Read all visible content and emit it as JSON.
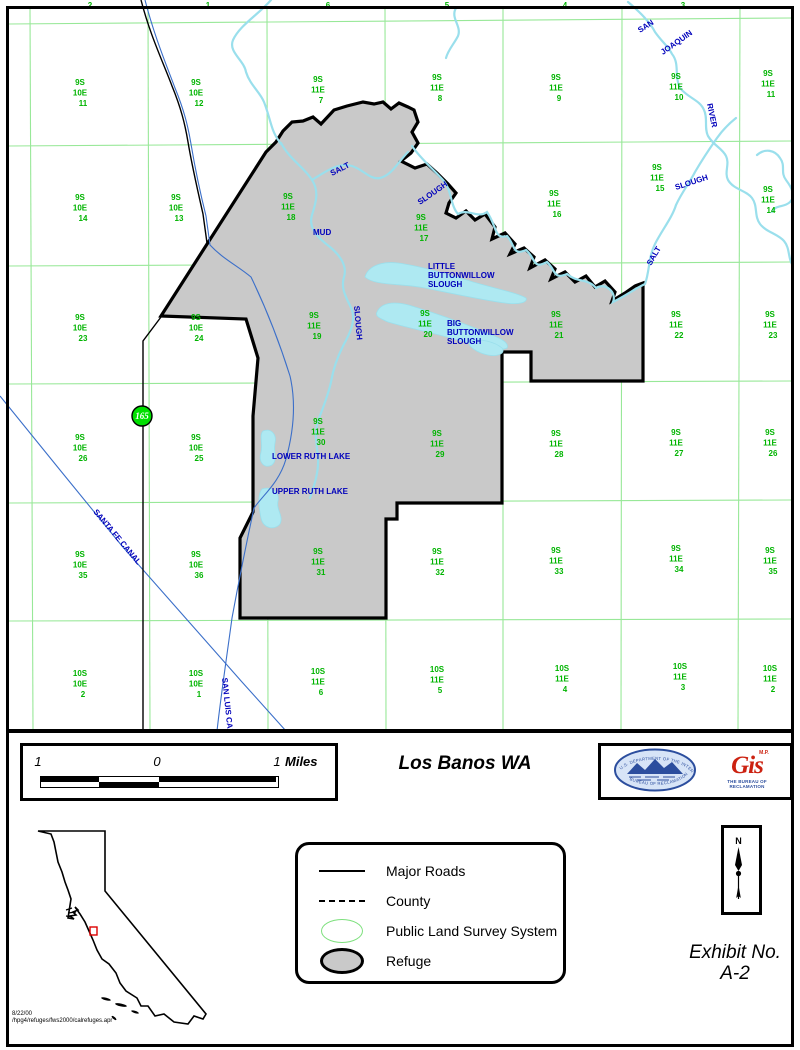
{
  "colors": {
    "plss_green": "#00b400",
    "grid_green": "#98e898",
    "water_blue": "#0000bb",
    "water_cyan": "#9adfec",
    "water_fill": "#aee9f2",
    "canal_blue": "#3b6fc9",
    "refuge_gray": "#c9c9c9",
    "shield_green": "#00e000",
    "logo_red": "#cc2211",
    "locator_red": "#dd0000",
    "seal_blue": "#2c4e9e"
  },
  "map": {
    "highway_shield": {
      "route": "165"
    },
    "plss_partial_top": [
      {
        "x": 90,
        "sec": "2"
      },
      {
        "x": 208,
        "sec": "1"
      },
      {
        "x": 328,
        "sec": "6"
      },
      {
        "x": 447,
        "sec": "5"
      },
      {
        "x": 565,
        "sec": "4"
      },
      {
        "x": 683,
        "sec": "3"
      }
    ],
    "plss_sections": [
      {
        "x": 80,
        "y": 85,
        "town": "9S",
        "range": "10E",
        "sec": "11"
      },
      {
        "x": 196,
        "y": 85,
        "town": "9S",
        "range": "10E",
        "sec": "12"
      },
      {
        "x": 318,
        "y": 82,
        "town": "9S",
        "range": "11E",
        "sec": "7"
      },
      {
        "x": 437,
        "y": 80,
        "town": "9S",
        "range": "11E",
        "sec": "8"
      },
      {
        "x": 556,
        "y": 80,
        "town": "9S",
        "range": "11E",
        "sec": "9"
      },
      {
        "x": 676,
        "y": 79,
        "town": "9S",
        "range": "11E",
        "sec": "10"
      },
      {
        "x": 768,
        "y": 76,
        "town": "9S",
        "range": "11E",
        "sec": "11"
      },
      {
        "x": 80,
        "y": 200,
        "town": "9S",
        "range": "10E",
        "sec": "14"
      },
      {
        "x": 176,
        "y": 200,
        "town": "9S",
        "range": "10E",
        "sec": "13"
      },
      {
        "x": 288,
        "y": 199,
        "town": "9S",
        "range": "11E",
        "sec": "18"
      },
      {
        "x": 421,
        "y": 220,
        "town": "9S",
        "range": "11E",
        "sec": "17"
      },
      {
        "x": 554,
        "y": 196,
        "town": "9S",
        "range": "11E",
        "sec": "16"
      },
      {
        "x": 657,
        "y": 170,
        "town": "9S",
        "range": "11E",
        "sec": "15"
      },
      {
        "x": 768,
        "y": 192,
        "town": "9S",
        "range": "11E",
        "sec": "14"
      },
      {
        "x": 80,
        "y": 320,
        "town": "9S",
        "range": "10E",
        "sec": "23"
      },
      {
        "x": 196,
        "y": 320,
        "town": "9S",
        "range": "10E",
        "sec": "24"
      },
      {
        "x": 314,
        "y": 318,
        "town": "9S",
        "range": "11E",
        "sec": "19"
      },
      {
        "x": 425,
        "y": 316,
        "town": "9S",
        "range": "11E",
        "sec": "20"
      },
      {
        "x": 556,
        "y": 317,
        "town": "9S",
        "range": "11E",
        "sec": "21"
      },
      {
        "x": 676,
        "y": 317,
        "town": "9S",
        "range": "11E",
        "sec": "22"
      },
      {
        "x": 770,
        "y": 317,
        "town": "9S",
        "range": "11E",
        "sec": "23"
      },
      {
        "x": 80,
        "y": 440,
        "town": "9S",
        "range": "10E",
        "sec": "26"
      },
      {
        "x": 196,
        "y": 440,
        "town": "9S",
        "range": "10E",
        "sec": "25"
      },
      {
        "x": 318,
        "y": 424,
        "town": "9S",
        "range": "11E",
        "sec": "30"
      },
      {
        "x": 437,
        "y": 436,
        "town": "9S",
        "range": "11E",
        "sec": "29"
      },
      {
        "x": 556,
        "y": 436,
        "town": "9S",
        "range": "11E",
        "sec": "28"
      },
      {
        "x": 676,
        "y": 435,
        "town": "9S",
        "range": "11E",
        "sec": "27"
      },
      {
        "x": 770,
        "y": 435,
        "town": "9S",
        "range": "11E",
        "sec": "26"
      },
      {
        "x": 80,
        "y": 557,
        "town": "9S",
        "range": "10E",
        "sec": "35"
      },
      {
        "x": 196,
        "y": 557,
        "town": "9S",
        "range": "10E",
        "sec": "36"
      },
      {
        "x": 318,
        "y": 554,
        "town": "9S",
        "range": "11E",
        "sec": "31"
      },
      {
        "x": 437,
        "y": 554,
        "town": "9S",
        "range": "11E",
        "sec": "32"
      },
      {
        "x": 556,
        "y": 553,
        "town": "9S",
        "range": "11E",
        "sec": "33"
      },
      {
        "x": 676,
        "y": 551,
        "town": "9S",
        "range": "11E",
        "sec": "34"
      },
      {
        "x": 770,
        "y": 553,
        "town": "9S",
        "range": "11E",
        "sec": "35"
      },
      {
        "x": 80,
        "y": 676,
        "town": "10S",
        "range": "10E",
        "sec": "2"
      },
      {
        "x": 196,
        "y": 676,
        "town": "10S",
        "range": "10E",
        "sec": "1"
      },
      {
        "x": 318,
        "y": 674,
        "town": "10S",
        "range": "11E",
        "sec": "6"
      },
      {
        "x": 437,
        "y": 672,
        "town": "10S",
        "range": "11E",
        "sec": "5"
      },
      {
        "x": 562,
        "y": 671,
        "town": "10S",
        "range": "11E",
        "sec": "4"
      },
      {
        "x": 680,
        "y": 669,
        "town": "10S",
        "range": "11E",
        "sec": "3"
      },
      {
        "x": 770,
        "y": 671,
        "town": "10S",
        "range": "11E",
        "sec": "2"
      }
    ],
    "water_labels": [
      {
        "text": "SAN",
        "x": 640,
        "y": 33,
        "rot": -33
      },
      {
        "text": "JOAQUIN",
        "x": 663,
        "y": 55,
        "rot": -35
      },
      {
        "text": "RIVER",
        "x": 707,
        "y": 104,
        "rot": 78
      },
      {
        "text": "SALT",
        "x": 332,
        "y": 176,
        "rot": -27
      },
      {
        "text": "SLOUGH",
        "x": 420,
        "y": 205,
        "rot": -35
      },
      {
        "text": "MUD",
        "x": 313,
        "y": 235,
        "rot": 0
      },
      {
        "text": "SLOUGH",
        "x": 354,
        "y": 306,
        "rot": 85
      },
      {
        "text": "SLOUGH",
        "x": 676,
        "y": 190,
        "rot": -18
      },
      {
        "text": "SALT",
        "x": 651,
        "y": 266,
        "rot": -60
      },
      {
        "lines": [
          "LITTLE",
          "BUTTONWILLOW",
          "SLOUGH"
        ],
        "x": 428,
        "y": 269
      },
      {
        "lines": [
          "BIG",
          "BUTTONWILLOW",
          "SLOUGH"
        ],
        "x": 447,
        "y": 326
      },
      {
        "text": "LOWER RUTH LAKE",
        "x": 272,
        "y": 459,
        "rot": 0
      },
      {
        "text": "UPPER RUTH LAKE",
        "x": 272,
        "y": 494,
        "rot": 0
      },
      {
        "text": "SANTA FE CANAL",
        "x": 93,
        "y": 512,
        "rot": 50
      },
      {
        "text": "SAN LUIS CANAL",
        "x": 222,
        "y": 678,
        "rot": 84
      }
    ]
  },
  "footer": {
    "scale_bar": {
      "left_label": "1",
      "mid_label": "0",
      "right_label": "1",
      "unit": "Miles"
    },
    "title": "Los Banos WA",
    "seal": {
      "top_text": "U.S. DEPARTMENT OF THE INTERIOR",
      "bottom_text": "BUREAU OF RECLAMATION"
    },
    "gis_logo": {
      "sup": "M.P.",
      "text": "Gis",
      "caption": "THE BUREAU OF RECLAMATION"
    },
    "legend": {
      "items": [
        {
          "symbol": "line",
          "label": "Major Roads"
        },
        {
          "symbol": "dash",
          "label": "County"
        },
        {
          "symbol": "green-ellipse",
          "label": "Public Land Survey System"
        },
        {
          "symbol": "gray-ellipse",
          "label": "Refuge"
        }
      ]
    },
    "north_label": "N",
    "exhibit": {
      "line1": "Exhibit No.",
      "line2": "A-2"
    },
    "credits": {
      "date": "8/22/00",
      "path": "/hpg4/refuges/fws2000/calrefuges.apr"
    }
  }
}
